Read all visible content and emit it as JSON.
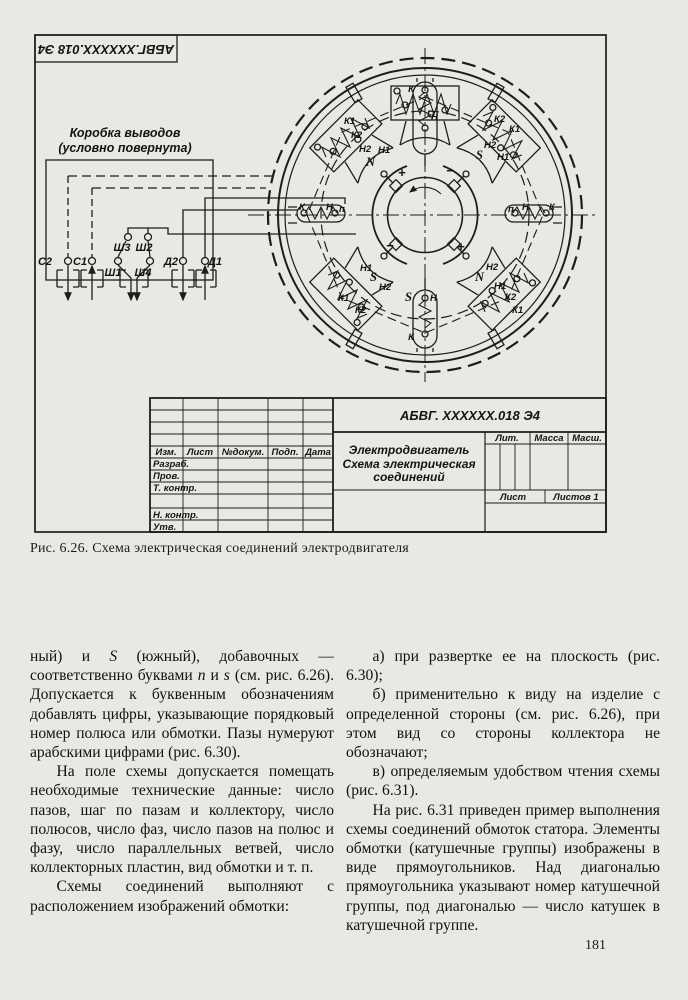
{
  "page": {
    "number": "181"
  },
  "caption": "Рис. 6.26. Схема электрическая соединений электродвигателя",
  "drawing": {
    "stamp": "АБВГ.ХХХХХХ.018 Э4",
    "box_label1": "Коробка выводов",
    "box_label2": "(условно повернута)",
    "terminals": {
      "c2": "С2",
      "c1": "С1",
      "sh1": "Ш1",
      "sh4": "Ш4",
      "d2": "Д2",
      "d1": "Д1",
      "sh3": "Ш3",
      "sh2": "Ш2"
    },
    "labels": {
      "k": "К",
      "n": "Н",
      "p": "п",
      "k1": "К1",
      "k2": "К2",
      "n1": "Н1",
      "n2": "Н2",
      "north": "N",
      "south": "S",
      "plus": "+",
      "minus": "−"
    }
  },
  "title_block": {
    "doc_number": "АБВГ. ХХХХХХ.018 Э4",
    "product": "Электродвигатель",
    "doc_title1": "Схема электрическая",
    "doc_title2": "соединений",
    "col_izm": "Изм.",
    "col_list": "Лист",
    "col_dokum": "№докум.",
    "col_podp": "Подп.",
    "col_data": "Дата",
    "row_razrab": "Разраб.",
    "row_prov": "Пров.",
    "row_tkontr": "Т. контр.",
    "row_nkontr": "Н. контр.",
    "row_utv": "Утв.",
    "lit": "Лит.",
    "massa": "Масса",
    "masshtab": "Масш.",
    "list": "Лист",
    "listov": "Листов 1"
  },
  "body": {
    "left": {
      "p1": [
        "ный) и ",
        "S",
        " (южный), добавочных — соответственно буквами ",
        "n",
        " и ",
        "s",
        " (см. рис. 6.26). Допускается к буквенным обозначениям добавлять цифры, указывающие порядковый номер полюса или обмотки. Пазы нумеруют арабскими цифрами (рис. 6.30)."
      ],
      "p2": "На поле схемы допускается помещать необходимые технические данные: число пазов, шаг по пазам и коллектору, число полюсов, число фаз, число пазов на полюс и фазу, число параллельных ветвей, число коллекторных пластин, вид обмотки и т. п.",
      "p3": "Схемы соединений выполняют с расположением изображений обмотки:"
    },
    "right": {
      "pa": "а) при развертке ее на плоскость (рис. 6.30);",
      "pb": "б) применительно к виду на изделие с определенной стороны (см. рис. 6.26), при этом вид со стороны коллектора не обозначают;",
      "pv": "в) определяемым удобством чтения схемы (рис. 6.31).",
      "p4": "На рис. 6.31 приведен пример выполнения схемы соединений обмоток статора. Элементы обмотки (катушечные группы) изображены в виде прямоугольников. Над диагональю прямоугольника указывают номер катушечной группы, под диагональю — число катушек в катушечной группе."
    }
  }
}
